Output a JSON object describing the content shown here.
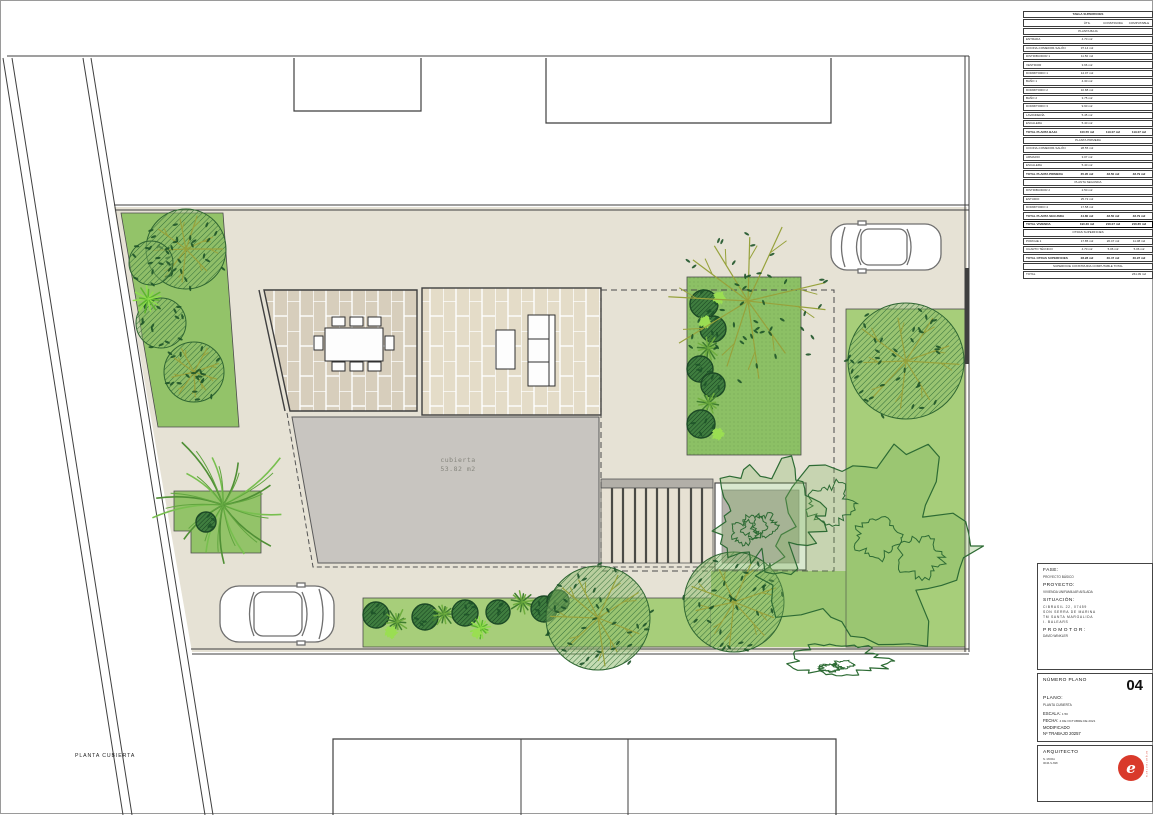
{
  "sheet": {
    "plan_label": "PLANTA CUBIERTA"
  },
  "plan": {
    "roof_label": "cubierta",
    "roof_area": "53.82 m2"
  },
  "surface_table": {
    "title": "TABLA SUPERFICIES",
    "columns": [
      "ÚTIL",
      "CONSTRUIDA",
      "COMPUTABLE"
    ],
    "rows": [
      {
        "type": "title",
        "label": "TABLA SUPERFICIES",
        "v1": "",
        "v2": "",
        "v3": ""
      },
      {
        "type": "head",
        "label": "",
        "v1": "ÚTIL",
        "v2": "CONSTRUIDA",
        "v3": "COMPUTABLE"
      },
      {
        "type": "section",
        "label": "PLANTA BAJA",
        "v1": "",
        "v2": "",
        "v3": ""
      },
      {
        "type": "data",
        "label": "ENTRADA",
        "v1": "4.70 m2",
        "v2": "",
        "v3": ""
      },
      {
        "type": "data",
        "label": "COCINA-COMEDOR-SALÓN",
        "v1": "37.14 m2",
        "v2": "",
        "v3": ""
      },
      {
        "type": "data",
        "label": "DISTRIBUIDOR 1",
        "v1": "11.50 m2",
        "v2": "",
        "v3": ""
      },
      {
        "type": "data",
        "label": "VESTIDOR",
        "v1": "3.66 m2",
        "v2": "",
        "v3": ""
      },
      {
        "type": "data",
        "label": "DORMITORIO 1",
        "v1": "14.07 m2",
        "v2": "",
        "v3": ""
      },
      {
        "type": "data",
        "label": "BAÑO 1",
        "v1": "4.30 m2",
        "v2": "",
        "v3": ""
      },
      {
        "type": "data",
        "label": "DORMITORIO 2",
        "v1": "10.88 m2",
        "v2": "",
        "v3": ""
      },
      {
        "type": "data",
        "label": "BAÑO 2",
        "v1": "3.75 m2",
        "v2": "",
        "v3": ""
      },
      {
        "type": "data",
        "label": "DORMITORIO 3",
        "v1": "9.90 m2",
        "v2": "",
        "v3": ""
      },
      {
        "type": "data",
        "label": "LAVANDERÍA",
        "v1": "5.45 m2",
        "v2": "",
        "v3": ""
      },
      {
        "type": "data",
        "label": "ESCALERA",
        "v1": "5.40 m2",
        "v2": "",
        "v3": ""
      },
      {
        "type": "total",
        "label": "TOTAL PLANTA BAJA",
        "v1": "100.55 m2",
        "v2": "119.07 m2",
        "v3": "119.07 m2"
      },
      {
        "type": "section",
        "label": "PLANTA PRIMERA",
        "v1": "",
        "v2": "",
        "v3": ""
      },
      {
        "type": "data",
        "label": "COCINA-COMEDOR-SALÓN",
        "v1": "28.55 m2",
        "v2": "",
        "v3": ""
      },
      {
        "type": "data",
        "label": "ARMARIO",
        "v1": "3.07 m2",
        "v2": "",
        "v3": ""
      },
      {
        "type": "data",
        "label": "ESCALERA",
        "v1": "5.40 m2",
        "v2": "",
        "v3": ""
      },
      {
        "type": "total",
        "label": "TOTAL PLANTA PRIMERA",
        "v1": "35.95 m2",
        "v2": "48.50 m2",
        "v3": "48.79 m2"
      },
      {
        "type": "section",
        "label": "PLANTA SEGUNDA",
        "v1": "",
        "v2": "",
        "v3": ""
      },
      {
        "type": "data",
        "label": "DISTRIBUIDOR 2",
        "v1": "2.50 m2",
        "v2": "",
        "v3": ""
      },
      {
        "type": "data",
        "label": "ESTUDIO",
        "v1": "25.72 m2",
        "v2": "",
        "v3": ""
      },
      {
        "type": "data",
        "label": "DORMITORIO 4",
        "v1": "17.58 m2",
        "v2": "",
        "v3": ""
      },
      {
        "type": "total",
        "label": "TOTAL PLANTA SEGUNDA",
        "v1": "44.80 m2",
        "v2": "48.50 m2",
        "v3": "48.79 m2"
      },
      {
        "type": "grand",
        "label": "TOTAL VIVIENDA",
        "v1": "190.30 m2",
        "v2": "216.07 m2",
        "v3": "216.65 m2"
      },
      {
        "type": "section",
        "label": "OTRAS SUPERFICIES",
        "v1": "",
        "v2": "",
        "v3": ""
      },
      {
        "type": "data",
        "label": "PORCHE 1",
        "v1": "17.85 m2",
        "v2": "20.47 m2",
        "v3": "11.08 m2"
      },
      {
        "type": "data",
        "label": "CUARTO TÉCNICO",
        "v1": "4.70 m2",
        "v2": "5.06 m2",
        "v3": "5.06 m2"
      },
      {
        "type": "total",
        "label": "TOTAL OTRAS SUPERFICIES",
        "v1": "28.28 m2",
        "v2": "30.47 m2",
        "v3": "30.97 m2"
      },
      {
        "type": "section",
        "label": "SUPERFICIE CONSTRUIDA COMPUTABLE TOTAL",
        "v1": "",
        "v2": "",
        "v3": ""
      },
      {
        "type": "data",
        "label": "TOTAL",
        "v1": "",
        "v2": "",
        "v3": "261.09 m2"
      }
    ]
  },
  "title_block": {
    "fase_label": "FASE:",
    "fase": "PROYECTO BÁSICO",
    "proyecto_label": "PROYECTO:",
    "proyecto": "VIVIENDA UNIFAMILIAR AISLADA",
    "situacion_label": "SITUACIÓN:",
    "situacion_lines": [
      "C/BRASIL 22, 07459",
      "SON SERRA DE MARINA",
      "TM SANTA MARGALIDA",
      "I. BALEARS"
    ],
    "promotor_label": "PROMOTOR:",
    "promotor": "DAVID WINKLER",
    "numero_plano_label": "NÚMERO PLANO",
    "numero_plano": "04",
    "plano_label": "PLANO:",
    "plano": "PLANTA CUBIERTA",
    "escala_label": "ESCALA:",
    "escala": "1:50",
    "fecha_label": "FECHA:",
    "fecha": "4 DE OCTUBRE DE 2021",
    "modificado": "MODIFICADO",
    "trabajo": "Nº TRABAJO 20257",
    "arquitecto_label": "ARQUITECTO",
    "arquitecto_lines": [
      "N. MORA",
      "0046-S-698"
    ],
    "logo_text": "e",
    "logo_side_text": "arquitectura"
  },
  "palette": {
    "parcel": "#e6e2d5",
    "lawn": "#a7ce7a",
    "lawn_bed": "#93c369",
    "bed_center": "#8cc065",
    "roof": "#c8c5c0",
    "tile_dark": "#d7cebc",
    "tile_light": "#e4dcc8",
    "line": "#3f3f3f",
    "tree_dark": "#1e5429",
    "tree_branch": "#97a23c",
    "plant_light": "#8ede4b",
    "accent_red": "#d93a2b"
  }
}
